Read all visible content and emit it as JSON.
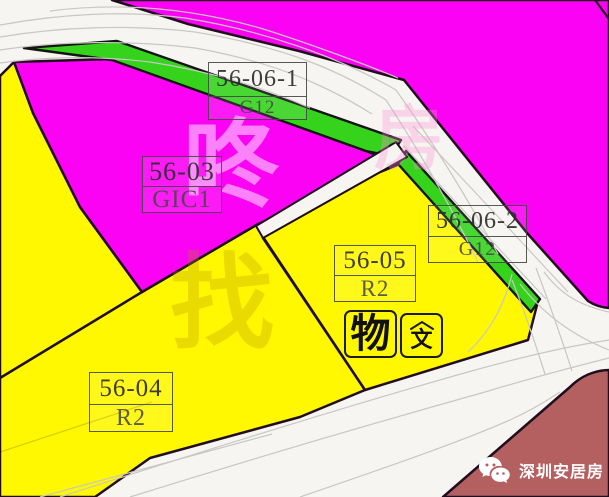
{
  "colors": {
    "magenta": "#FB02F4",
    "yellow": "#FFF800",
    "green": "#35D31C",
    "maroon": "#B56060",
    "road": "#F7F5F1",
    "outline": "#200E1E"
  },
  "parcels": {
    "a": {
      "code": "56-06-1",
      "use": "G12"
    },
    "b": {
      "code": "56-03",
      "use": "GIC1"
    },
    "c": {
      "code": "56-06-2",
      "use": "G12"
    },
    "d": {
      "code": "56-05",
      "use": "R2"
    },
    "e": {
      "code": "56-04",
      "use": "R2"
    }
  },
  "landmarks": {
    "relic_main": "物",
    "relic_sub": "文"
  },
  "watermarks": {
    "w1": "咚",
    "w2": "找",
    "w3": "房"
  },
  "footer": {
    "brand": "深圳安居房",
    "icon": "wechat-icon"
  }
}
